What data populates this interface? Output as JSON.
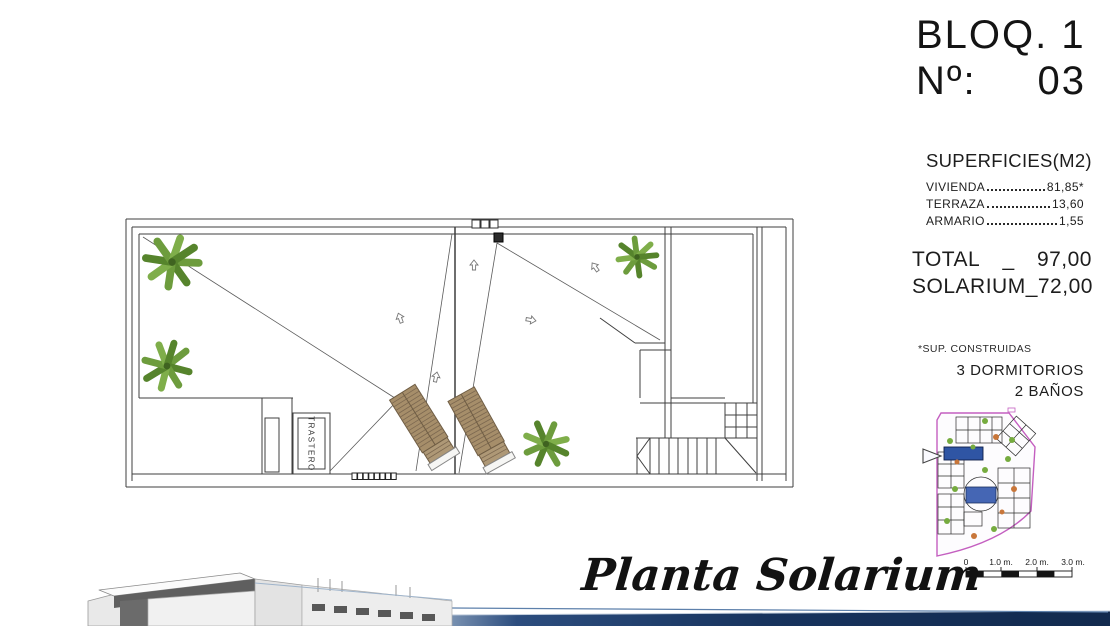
{
  "header": {
    "block": "BLOQ. 1",
    "unit_label": "Nº:",
    "unit_number": "03"
  },
  "surfaces": {
    "title": "SUPERFICIES(M2)",
    "rows": [
      {
        "label": "VIVIENDA",
        "value": "81,85*"
      },
      {
        "label": "TERRAZA",
        "value": "13,60"
      },
      {
        "label": "ARMARIO",
        "value": "1,55"
      }
    ],
    "totals": [
      {
        "label": "TOTAL",
        "sep": "_",
        "value": "97,00"
      },
      {
        "label": "SOLARIUM",
        "sep": "_",
        "value": "72,00"
      }
    ],
    "footnote": "*SUP. CONSTRUIDAS"
  },
  "features": {
    "bedrooms": "3 DORMITORIOS",
    "bathrooms": "2 BAÑOS"
  },
  "floor_plan": {
    "caption": "Planta Solarium",
    "room_label": "TRASTERO"
  },
  "minimap": {
    "scale_labels": [
      "0",
      "1.0 m.",
      "2.0 m.",
      "3.0 m."
    ]
  },
  "colors": {
    "unit_highlight_blue": "#2f55a4",
    "pool_blue": "#4566b4",
    "site_boundary_magenta": "#c45fc0",
    "palm_green": "#6d9c3d",
    "lounger_wood": "#a68e6a",
    "footer_bar_navy": "#17335d"
  }
}
